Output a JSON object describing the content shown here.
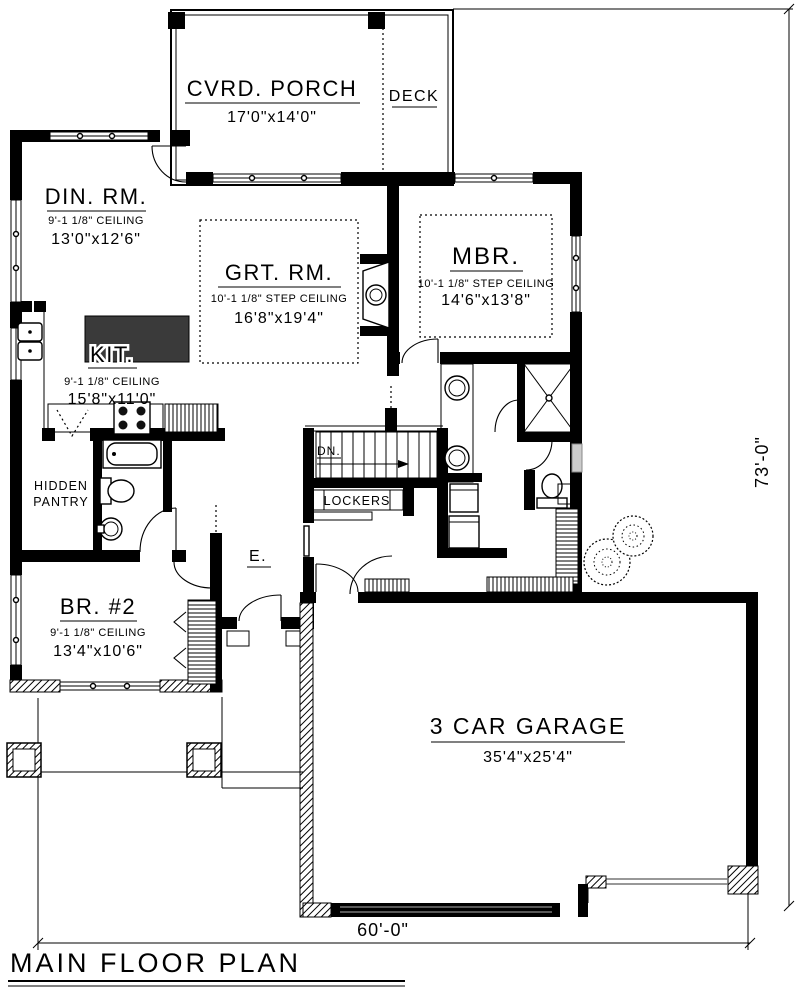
{
  "plan": {
    "title": "MAIN FLOOR PLAN",
    "dims": {
      "width": "60'-0\"",
      "height": "73'-0\""
    },
    "rooms": {
      "porch": {
        "name": "CVRD. PORCH",
        "size": "17'0\"x14'0\""
      },
      "deck": {
        "name": "DECK"
      },
      "dining": {
        "name": "DIN. RM.",
        "ceiling": "9'-1 1/8\" CEILING",
        "size": "13'0\"x12'6\""
      },
      "great": {
        "name": "GRT. RM.",
        "ceiling": "10'-1 1/8\" STEP CEILING",
        "size": "16'8\"x19'4\""
      },
      "master": {
        "name": "MBR.",
        "ceiling": "10'-1 1/8\" STEP CEILING",
        "size": "14'6\"x13'8\""
      },
      "kitchen": {
        "name": "KIT.",
        "ceiling": "9'-1 1/8\" CEILING",
        "size": "15'8\"x11'0\""
      },
      "pantry": {
        "name_line1": "HIDDEN",
        "name_line2": "PANTRY"
      },
      "bed2": {
        "name": "BR. #2",
        "ceiling": "9'-1 1/8\" CEILING",
        "size": "13'4\"x10'6\""
      },
      "entry": {
        "name": "E."
      },
      "garage": {
        "name": "3 CAR GARAGE",
        "size": "35'4\"x25'4\""
      },
      "stair": {
        "label": "DN."
      },
      "lockers": {
        "label": "LOCKERS"
      }
    },
    "colors": {
      "line": "#000000",
      "paper": "#ffffff",
      "island_fill": "#3a3a3a"
    }
  }
}
